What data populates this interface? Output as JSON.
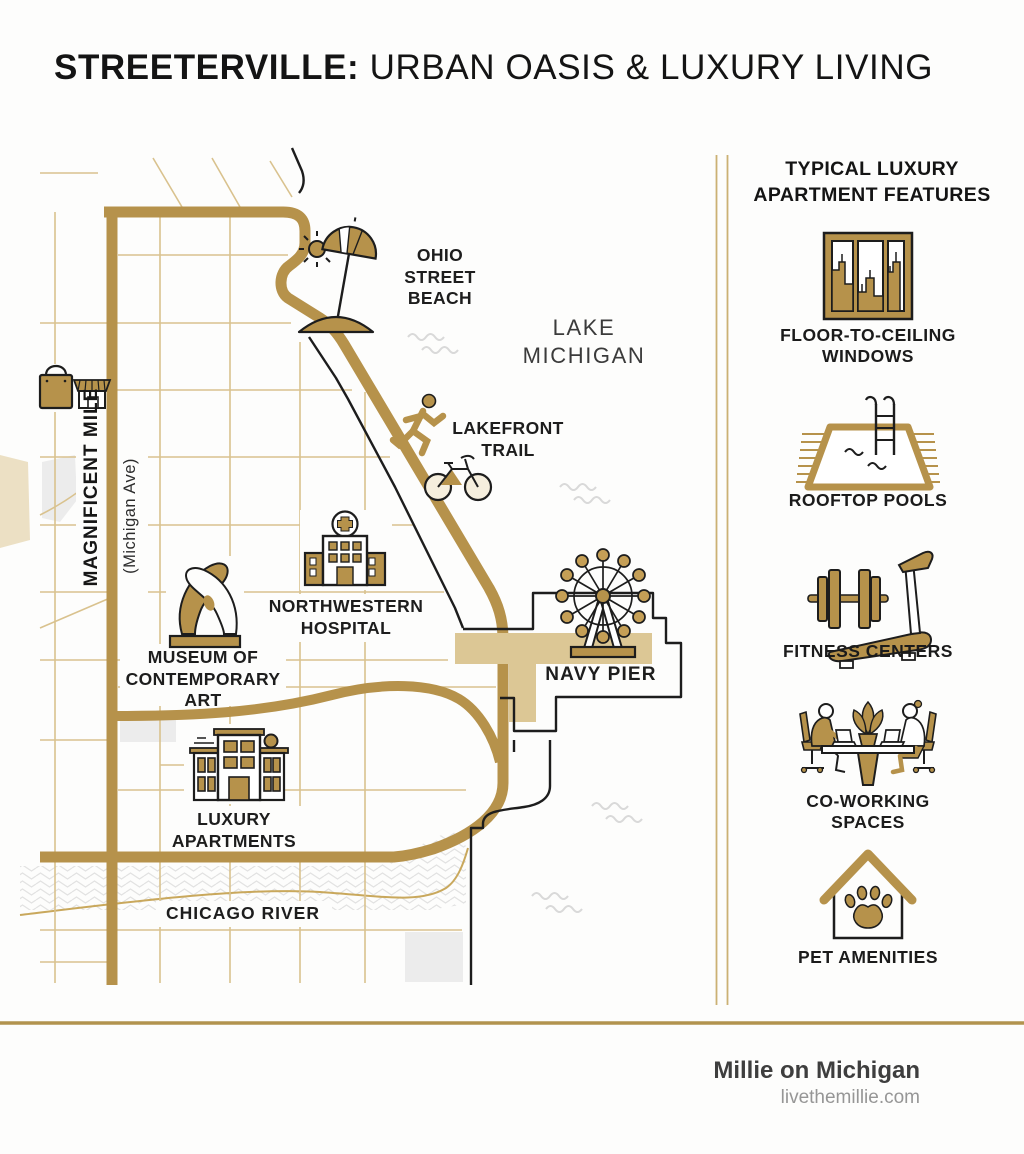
{
  "title": {
    "highlight": "STREETERVILLE:",
    "rest": " URBAN OASIS & LUXURY LIVING"
  },
  "map": {
    "labels": {
      "ohio_street_beach": {
        "lines": [
          "OHIO STREET",
          "BEACH"
        ]
      },
      "lake_michigan": {
        "lines": [
          "LAKE",
          "MICHIGAN"
        ]
      },
      "lakefront_trail": {
        "lines": [
          "LAKEFRONT",
          "TRAIL"
        ]
      },
      "northwestern_hospital": {
        "lines": [
          "NORTHWESTERN",
          "HOSPITAL"
        ]
      },
      "museum_of_contemporary_art": {
        "lines": [
          "MUSEUM OF",
          "CONTEMPORARY",
          "ART"
        ]
      },
      "navy_pier": {
        "lines": [
          "NAVY PIER"
        ]
      },
      "luxury_apartments": {
        "lines": [
          "LUXURY",
          "APARTMENTS"
        ]
      },
      "chicago_river": {
        "lines": [
          "CHICAGO RIVER"
        ]
      },
      "magnificent_mile": {
        "lines": [
          "MAGNIFICENT MILE"
        ]
      },
      "michigan_ave": {
        "lines": [
          "(Michigan Ave)"
        ]
      }
    }
  },
  "sidebar": {
    "heading": {
      "lines": [
        "TYPICAL LUXURY",
        "APARTMENT FEATURES"
      ]
    },
    "features": [
      {
        "icon": "floor-to-ceiling-windows-icon",
        "lines": [
          "FLOOR-TO-CEILING",
          "WINDOWS"
        ]
      },
      {
        "icon": "rooftop-pool-icon",
        "lines": [
          "ROOFTOP POOLS"
        ]
      },
      {
        "icon": "fitness-center-icon",
        "lines": [
          "FITNESS CENTERS"
        ]
      },
      {
        "icon": "co-working-icon",
        "lines": [
          "CO-WORKING",
          "SPACES"
        ]
      },
      {
        "icon": "pet-amenities-icon",
        "lines": [
          "PET AMENITIES"
        ]
      }
    ]
  },
  "footer": {
    "brand": "Millie on Michigan",
    "url": "livethemillie.com"
  },
  "colors": {
    "road_gold": "#b6924b",
    "street_gold": "#d9c28e",
    "pier_tan": "#dcc795",
    "ink": "#1d1d1d",
    "lake_wave_gray": "#d9d9d9",
    "river_gray": "#e2e2e2",
    "footer_brand": "#3e3e3e",
    "footer_url": "#969696"
  }
}
